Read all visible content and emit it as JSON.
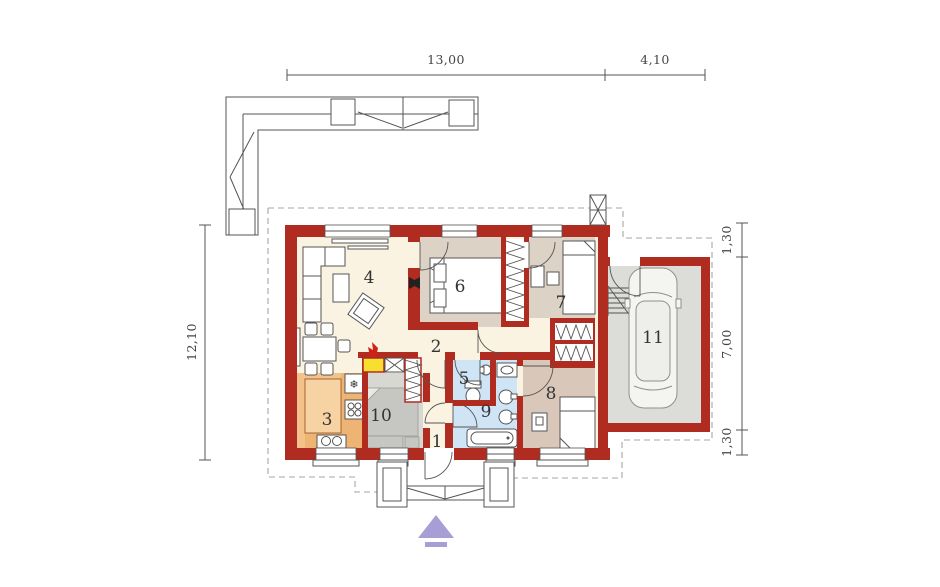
{
  "plan": {
    "title": "single-storey house floor plan with garage",
    "dimensions": {
      "top_width": "13,00",
      "top_garage": "4,10",
      "left_depth": "12,10",
      "right_top": "1,30",
      "right_middle": "7,00",
      "right_bottom": "1,30"
    },
    "rooms": {
      "r1": "1",
      "r2": "2",
      "r3": "3",
      "r4": "4",
      "r5": "5",
      "r6": "6",
      "r7": "7",
      "r8": "8",
      "r9": "9",
      "r10": "10",
      "r11": "11"
    },
    "icons": {
      "fridge": "❄"
    },
    "colors": {
      "wall_red": "#b02b20",
      "floor_cream": "#faf3e1",
      "floor_tan": "#ddd2c6",
      "floor_tan_dark": "#d9c8ba",
      "floor_kitchen": "#f3c18a",
      "kitchen_island": "#f7d3a4",
      "floor_bath": "#cfe4f5",
      "floor_garage": "#dcdcd8",
      "floor_utility": "#d8d8d3",
      "furniture_gray": "#c6c6c2",
      "fireplace_yellow": "#f6df2e",
      "flame_red": "#cf2318",
      "arrow_purple": "#a79ed6"
    }
  }
}
